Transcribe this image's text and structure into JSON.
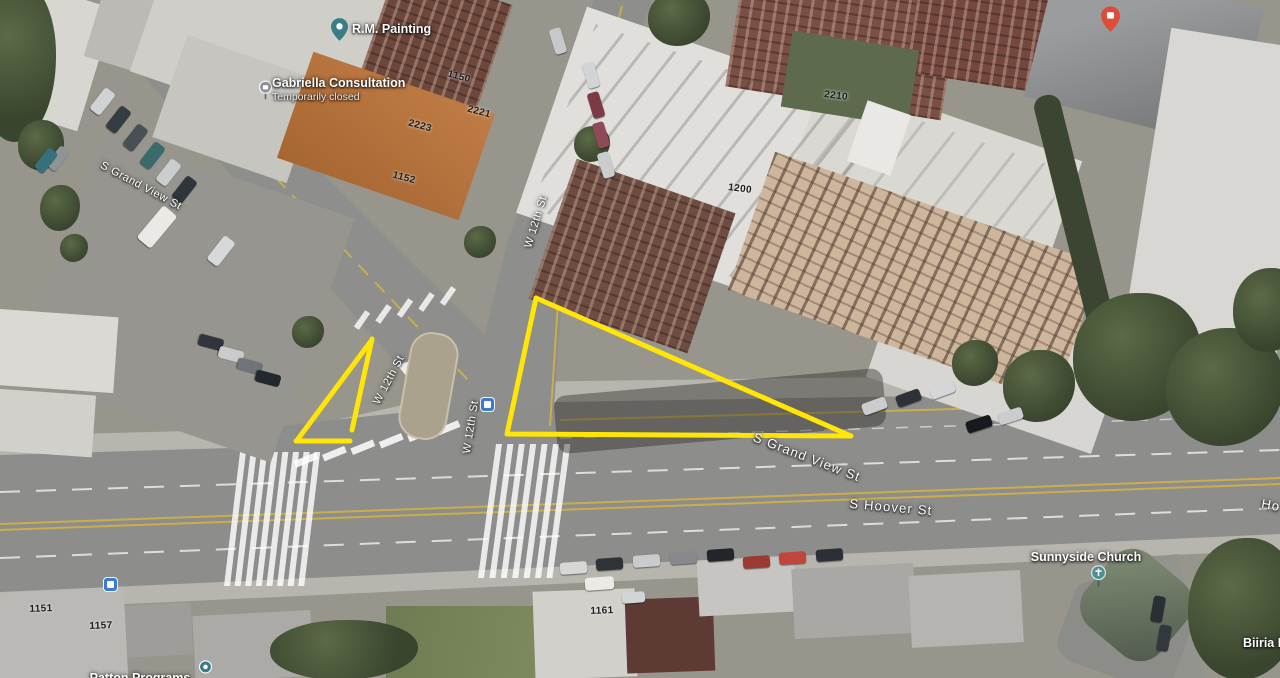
{
  "map": {
    "type": "satellite-aerial-view",
    "area": "W 12th St / S Grand View St / S Hoover St intersection"
  },
  "streets": {
    "grand_view_west": "S Grand View St",
    "w12th_upper": "W 12th St",
    "w12th_middle": "W 12th St",
    "w12th_lower": "W 12th St",
    "grand_view_east": "S Grand View St",
    "hoover": "S Hoover St",
    "hoover_right_partial": "Ho"
  },
  "places": {
    "rm_painting": {
      "label": "R.M. Painting"
    },
    "gabriella": {
      "label": "Gabriella Consultation",
      "status": "Temporarily closed"
    },
    "sunnyside_church": {
      "label": "Sunnyside Church"
    },
    "biiria": {
      "label": "Biiria Lo"
    },
    "patton": {
      "label": "Patton Programs"
    }
  },
  "building_numbers": {
    "n1150": "1150",
    "n2221": "2221",
    "n2223": "2223",
    "n1152": "1152",
    "n2210": "2210",
    "n1200": "1200",
    "n1151": "1151",
    "n1157": "1157",
    "n1161": "1161"
  },
  "annotations": {
    "color": "#FFE606",
    "stroke_width": 5,
    "shapes": [
      {
        "name": "large-triangle",
        "points": [
          [
            536,
            298
          ],
          [
            507,
            434
          ],
          [
            851,
            436
          ],
          [
            536,
            298
          ]
        ]
      },
      {
        "name": "small-triangle-hypotenuse",
        "points": [
          [
            371,
            341
          ],
          [
            298,
            439
          ]
        ]
      },
      {
        "name": "small-triangle-right-edge",
        "points": [
          [
            372,
            339
          ],
          [
            352,
            430
          ]
        ]
      },
      {
        "name": "small-triangle-base",
        "points": [
          [
            296,
            441
          ],
          [
            350,
            441
          ]
        ]
      }
    ]
  }
}
